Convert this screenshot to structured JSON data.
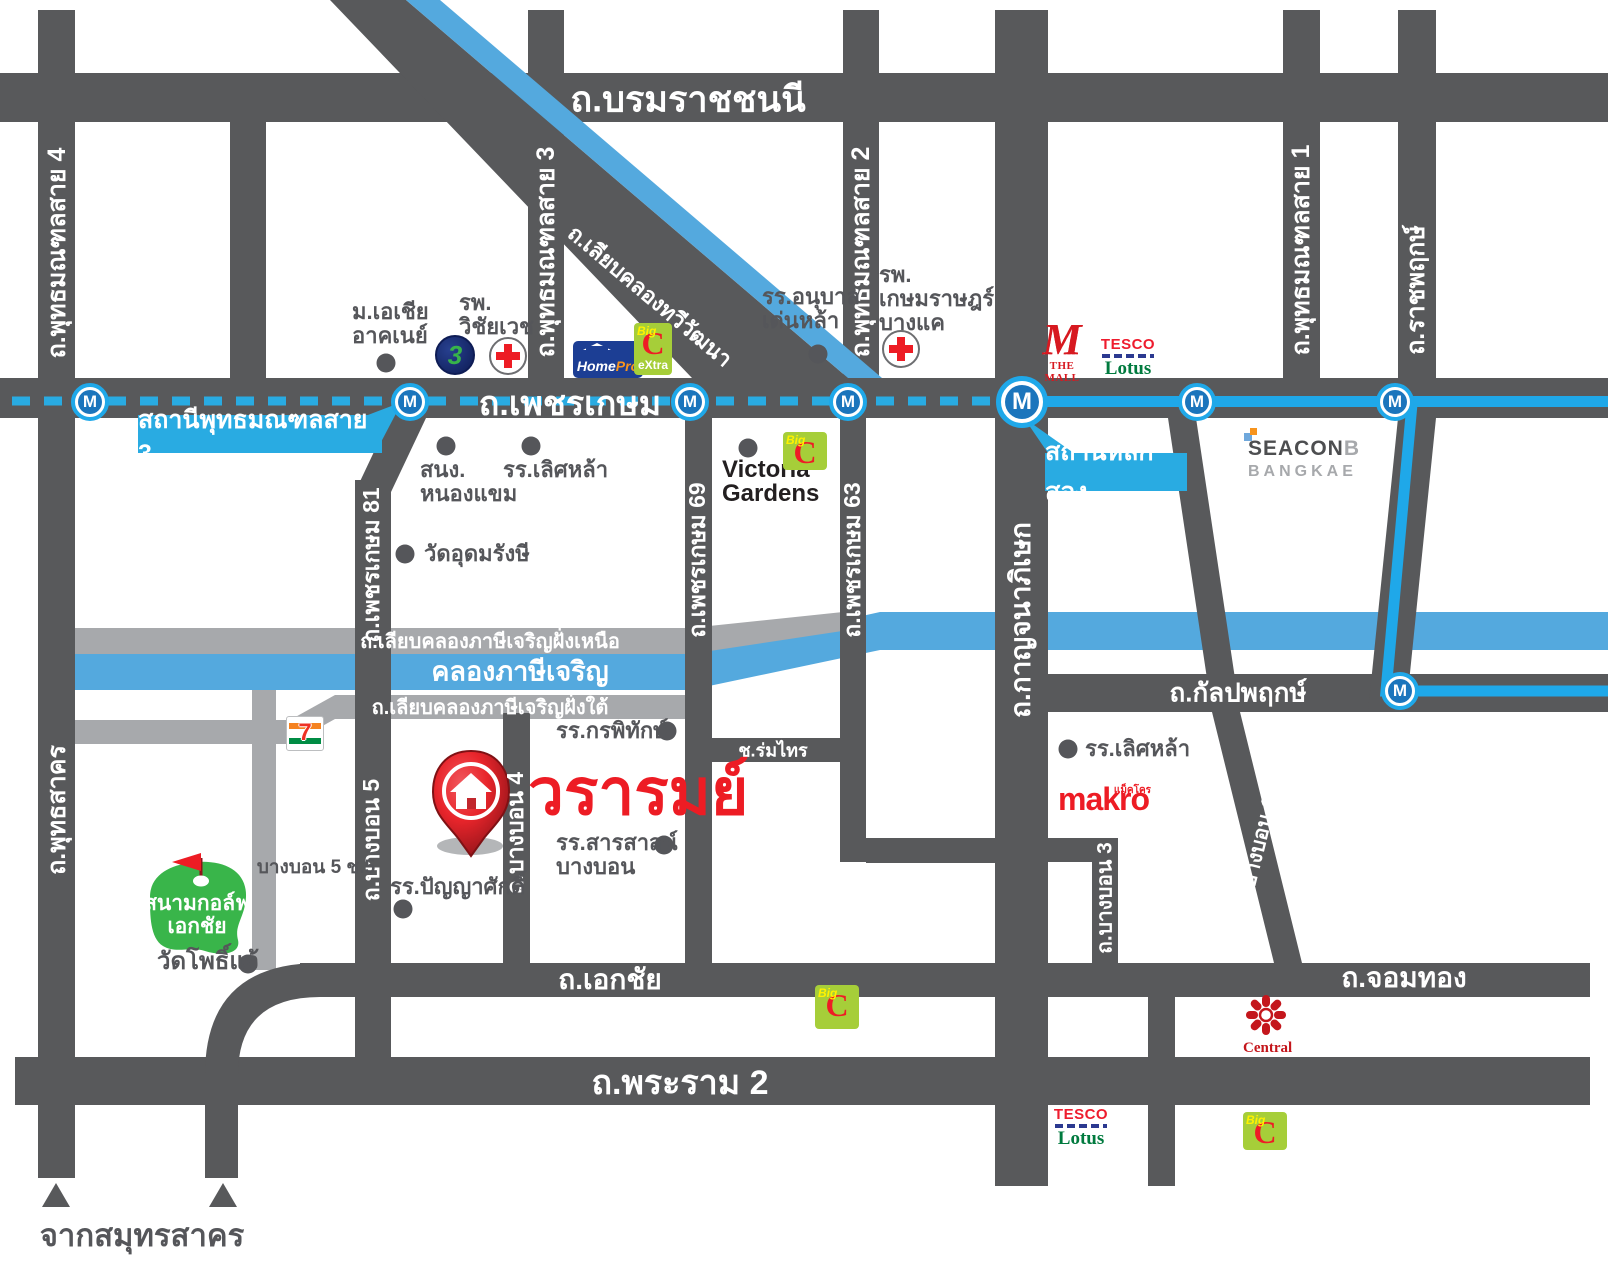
{
  "colors": {
    "road_dark": "#58595B",
    "road_minor": "#A7A9AC",
    "canal_blue": "#54A9DE",
    "mrt_line": "#1FA8E9",
    "station_callout": "#29ABE2",
    "mrt_icon_inner": "#1B75BC",
    "accent_red": "#ED1C24",
    "golf_green": "#39B54A"
  },
  "roads": {
    "borommaratchachonnani": "ถ.บรมราชชนนี",
    "phetkasem": "ถ.เพชรเกษม",
    "phutthamonthon_sai4": "ถ.พุทธมณฑลสาย 4",
    "phutthamonthon_sai3": "ถ.พุทธมณฑลสาย 3",
    "phutthamonthon_sai2": "ถ.พุทธมณฑลสาย 2",
    "phutthamonthon_sai1": "ถ.พุทธมณฑลสาย 1",
    "ratchaphruek": "ถ.ราชพฤกษ์",
    "kanchanaphisek": "ถ.กาญจนาภิเษก",
    "liap_khlong_thawi_watthana": "ถ.เลียบคลองทวีวัฒนา",
    "phetkasem81": "ถ.เพชรเกษม 81",
    "phetkasem69": "ถ.เพชรเกษม 69",
    "phetkasem63": "ถ.เพชรเกษม 63",
    "liap_khlong_north": "ถ.เลียบคลองภาษีเจริญฝั่งเหนือ",
    "khlong_phasi_charoen": "คลองภาษีเจริญ",
    "liap_khlong_south": "ถ.เลียบคลองภาษีเจริญฝั่งใต้",
    "kanlapaphruek": "ถ.กัลปพฤกษ์",
    "phutthasakhon": "ถ.พุทธสาคร",
    "bangbon5": "ถ.บางบอน 5",
    "bangbon4": "ถ.บางบอน 4",
    "bangbon3": "ถ.บางบอน 3",
    "bangbon1": "ถ.บางบอน 1",
    "soi_rom_sai": "ช.ร่มไทร",
    "ekachai": "ถ.เอกชัย",
    "chom_thong": "ถ.จอมทอง",
    "rama2": "ถ.พระราม 2",
    "bangbon5_soi5": "บางบอน 5 ช.5",
    "from_samut_sakhon": "จากสมุทรสาคร"
  },
  "stations": {
    "m": "M",
    "phutthamonthon_sai3": "สถานีพุทธมณฑลสาย 3",
    "lak_song": "สถานีหลักสอง"
  },
  "landmarks": {
    "asia_university": [
      "ม.เอเชีย",
      "อาคเนย์"
    ],
    "wichaiwej_hospital": [
      "รพ.",
      "วิชัยเวช"
    ],
    "denla_kindergarten": [
      "รร.อนุบาล",
      "เด่นหล้า"
    ],
    "kasemrad_hospital": [
      "รพ.",
      "เกษมราษฎร์",
      "บางแค"
    ],
    "nongkhaem_office": [
      "สนง.",
      "หนองแขม"
    ],
    "lertlah_school_north": "รร.เลิศหล้า",
    "wat_udomrangsi": "วัดอุดมรังษี",
    "victoria_gardens": [
      "Victoria",
      "Gardens"
    ],
    "kornpitack_school": "รร.กรพิทักษ์",
    "sarasas_school": [
      "รร.สารสาสน์",
      "บางบอน"
    ],
    "panyasak_school": "รร.ปัญญาศักดิ์",
    "lertlah_school_south": "รร.เลิศหล้า",
    "ekachai_golf_course": [
      "สนามกอล์ฟ",
      "เอกชัย"
    ],
    "wat_pho_chae": "วัดโพธิ์แจ้"
  },
  "project": {
    "name": "วรารมย์"
  },
  "logos": {
    "homepro": {
      "home": "Home",
      "pro": "Pro"
    },
    "bigc": {
      "big": "Big",
      "c": "C",
      "extra": "eXtra"
    },
    "ch3": "3",
    "the_mall": {
      "m": "M",
      "text": "THE MALL"
    },
    "tesco_lotus": {
      "tesco": "TESCO",
      "lotus": "Lotus"
    },
    "seacon": {
      "seacon": "SEACON",
      "b": "B",
      "bangkae": "BANGKAE"
    },
    "seven_eleven": {
      "seven": "7"
    },
    "makro": {
      "en": "makro",
      "th": "แม็คโคร"
    },
    "central": "Central"
  }
}
